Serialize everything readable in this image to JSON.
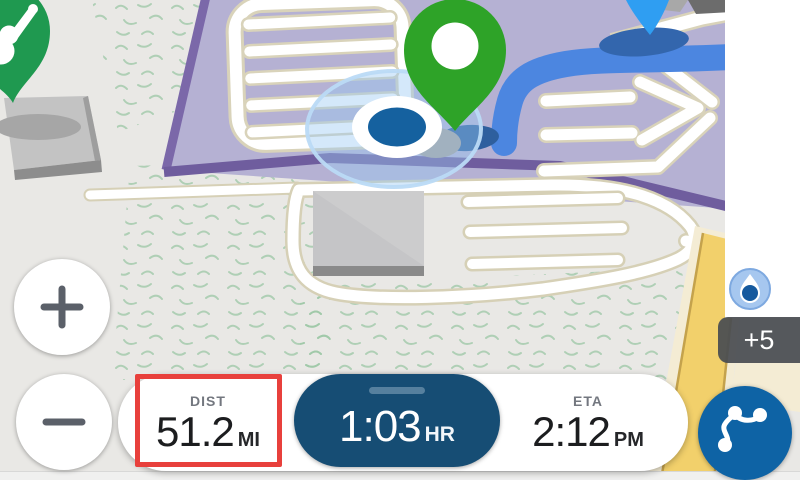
{
  "app": {
    "type": "gps-navigation-map-screen"
  },
  "map": {
    "markers": [
      {
        "name": "destination-pin",
        "color": "#2ea328"
      },
      {
        "name": "poi-music-venue-pin",
        "color": "#1f9950"
      },
      {
        "name": "next-maneuver-pin",
        "color": "#2f9ef2"
      },
      {
        "name": "current-location-indicator",
        "color": "#15619f"
      }
    ],
    "route_color": "#4c86e0",
    "parking_lot_color": "#b5b1d3",
    "highlighted_road_color": "#f2d06b"
  },
  "controls": {
    "zoom_in_icon": "plus-icon",
    "zoom_out_icon": "minus-icon",
    "route_overview_icon": "route-icon",
    "location_layer_icon": "droplet-icon"
  },
  "notifications": {
    "badge_label": "+5"
  },
  "nav_bar": {
    "dist": {
      "label": "DIST",
      "value": "51.2",
      "unit": "MI"
    },
    "time": {
      "value": "1:03",
      "unit": "HR"
    },
    "eta": {
      "label": "ETA",
      "value": "2:12",
      "unit": "PM"
    }
  },
  "annotation": {
    "target": "dist-field",
    "color": "#e8403c"
  }
}
